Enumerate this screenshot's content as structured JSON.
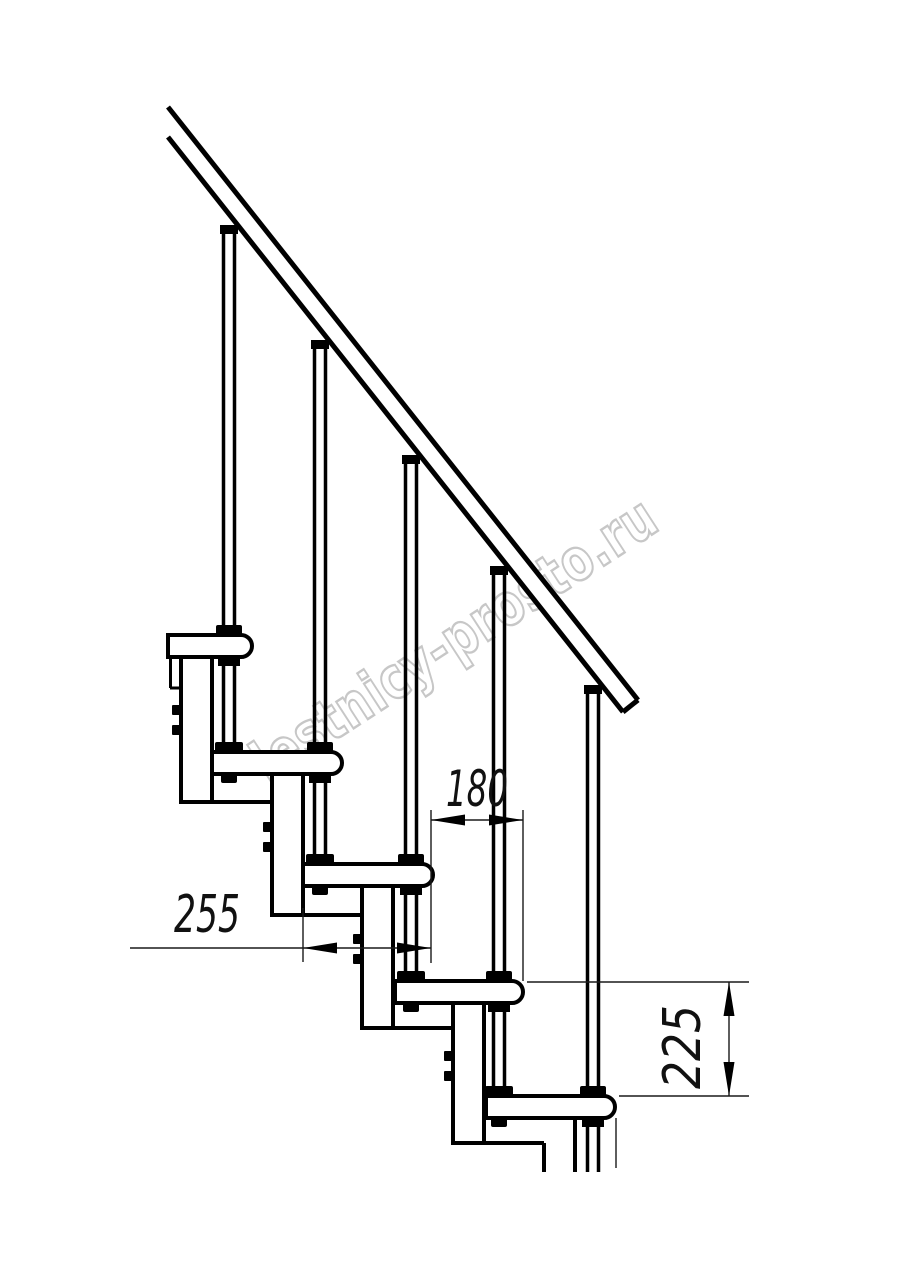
{
  "drawing": {
    "background": "#ffffff",
    "line_color": "#000000",
    "dim_line_color": "#1a1a1a"
  },
  "watermark": {
    "text": "lestnicy-prosto.ru",
    "color": "#c7c7c7"
  },
  "dimensions": {
    "step_run": {
      "value": "180"
    },
    "tread_length": {
      "value": "255"
    },
    "step_rise": {
      "value": "225"
    }
  }
}
